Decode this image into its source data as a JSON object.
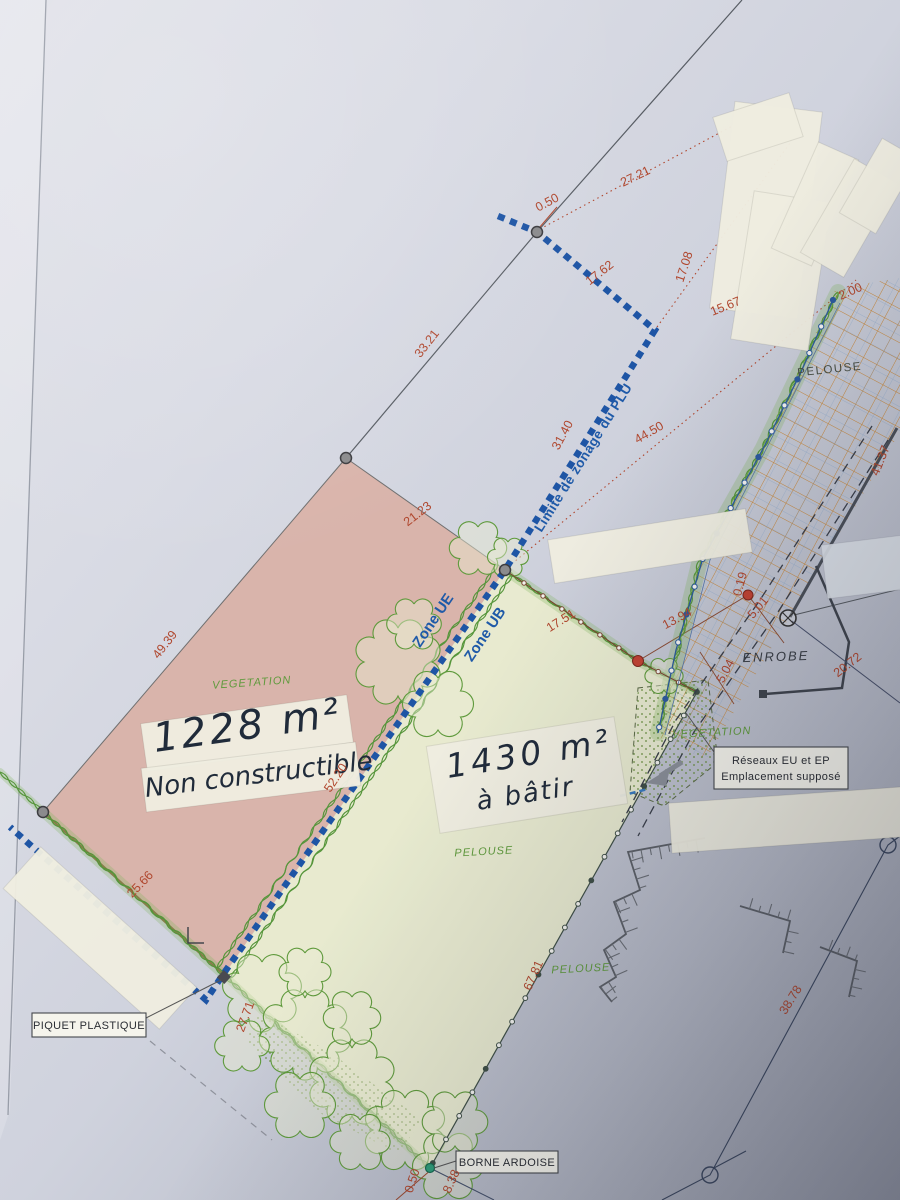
{
  "plan_labels": {
    "plu_line": "Limite de zonage du PLU",
    "zone_ue": "Zone UE",
    "zone_ub": "Zone UB"
  },
  "handwritten": {
    "left_area": "1228 m²",
    "left_note": "Non constructible",
    "right_area": "1430 m²",
    "right_note": "à bâtir"
  },
  "boxed_labels": {
    "piquet": "PIQUET PLASTIQUE",
    "borne": "BORNE ARDOISE",
    "reseaux_line1": "Réseaux EU et EP",
    "reseaux_line2": "Emplacement supposé"
  },
  "surface_labels": [
    {
      "text": "VEGETATION",
      "x": 252,
      "y": 686,
      "rot": -4,
      "style": "green"
    },
    {
      "text": "PELOUSE",
      "x": 830,
      "y": 373,
      "rot": -6,
      "style": "dark"
    },
    {
      "text": "PELOUSE",
      "x": 484,
      "y": 855,
      "rot": -3,
      "style": "green"
    },
    {
      "text": "PELOUSE",
      "x": 581,
      "y": 972,
      "rot": -3,
      "style": "green"
    },
    {
      "text": "VEGETATION",
      "x": 712,
      "y": 736,
      "rot": -3,
      "style": "green"
    },
    {
      "text": "ENROBE",
      "x": 776,
      "y": 661,
      "rot": -2,
      "style": "enrobe"
    }
  ],
  "dimensions": [
    {
      "value": "0.50",
      "x": 549,
      "y": 206,
      "rot": -28
    },
    {
      "value": "27.21",
      "x": 637,
      "y": 180,
      "rot": -26
    },
    {
      "value": "17.62",
      "x": 602,
      "y": 276,
      "rot": -38
    },
    {
      "value": "17.08",
      "x": 688,
      "y": 268,
      "rot": -72
    },
    {
      "value": "15.67",
      "x": 727,
      "y": 310,
      "rot": -22
    },
    {
      "value": "33.21",
      "x": 430,
      "y": 346,
      "rot": -52
    },
    {
      "value": "31.40",
      "x": 566,
      "y": 437,
      "rot": -62
    },
    {
      "value": "44.50",
      "x": 651,
      "y": 436,
      "rot": -30
    },
    {
      "value": "21.23",
      "x": 420,
      "y": 517,
      "rot": -38
    },
    {
      "value": "49.39",
      "x": 168,
      "y": 647,
      "rot": -52
    },
    {
      "value": "2.00",
      "x": 852,
      "y": 295,
      "rot": -24
    },
    {
      "value": "41.37",
      "x": 884,
      "y": 462,
      "rot": -68
    },
    {
      "value": "17.51",
      "x": 563,
      "y": 624,
      "rot": -32
    },
    {
      "value": "13.94",
      "x": 679,
      "y": 622,
      "rot": -28
    },
    {
      "value": "0.19",
      "x": 744,
      "y": 585,
      "rot": -75
    },
    {
      "value": "5.01",
      "x": 761,
      "y": 610,
      "rot": -50
    },
    {
      "value": "5.04",
      "x": 729,
      "y": 673,
      "rot": -62
    },
    {
      "value": "20.72",
      "x": 850,
      "y": 668,
      "rot": -38
    },
    {
      "value": "52.20",
      "x": 339,
      "y": 780,
      "rot": -56
    },
    {
      "value": "25.66",
      "x": 143,
      "y": 887,
      "rot": -46
    },
    {
      "value": "27.71",
      "x": 249,
      "y": 1018,
      "rot": -70
    },
    {
      "value": "67.81",
      "x": 537,
      "y": 977,
      "rot": -66
    },
    {
      "value": "38.78",
      "x": 794,
      "y": 1002,
      "rot": -58
    },
    {
      "value": "0.50",
      "x": 416,
      "y": 1182,
      "rot": -72
    },
    {
      "value": "8.38",
      "x": 455,
      "y": 1183,
      "rot": -66
    }
  ],
  "colors": {
    "plu_blue": "#1f5aa8",
    "dimension_red": "#b0472e",
    "vegetation_green": "#5f9a3c",
    "grid_orange": "#c8883a",
    "parcel_pink": "#d9b2a7",
    "parcel_yellow": "#e9ebcf"
  }
}
